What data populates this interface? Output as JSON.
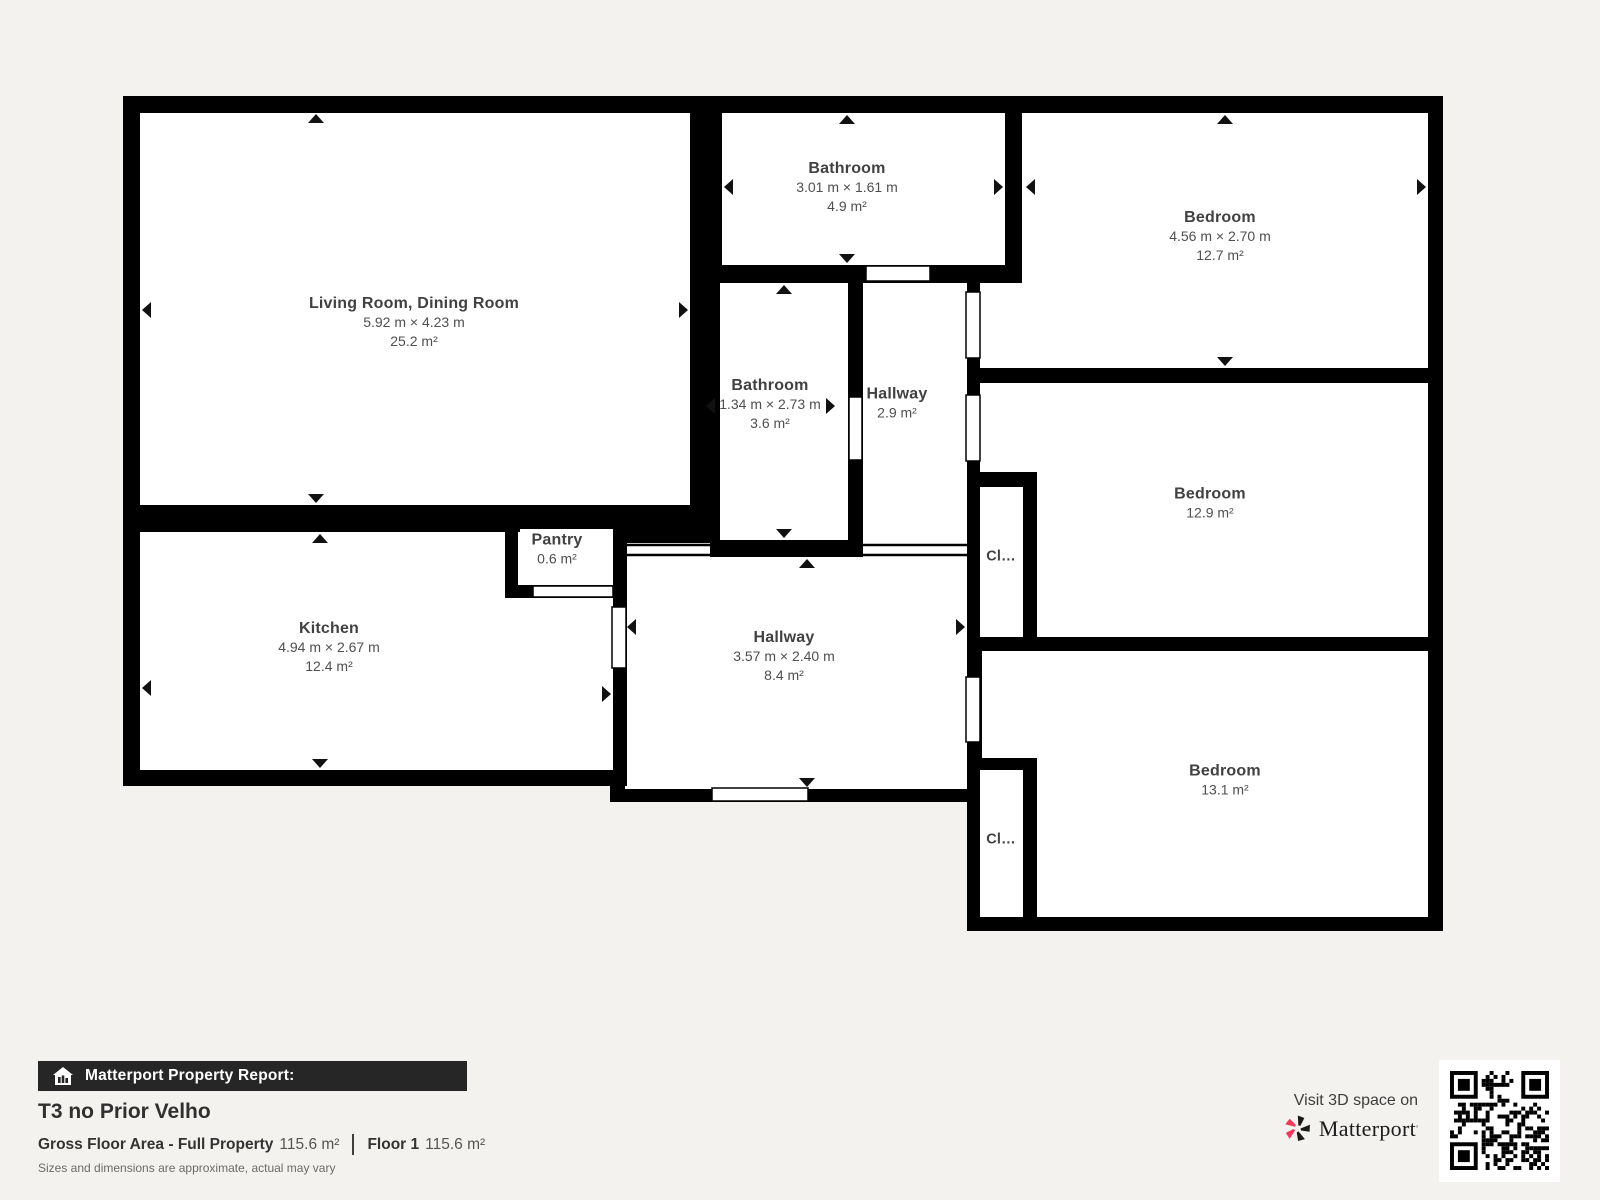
{
  "plan": {
    "rooms": [
      {
        "id": "living-dining",
        "name": "Living Room, Dining Room",
        "dims": "5.92 m × 4.23 m",
        "area": "25.2 m²"
      },
      {
        "id": "bathroom-top",
        "name": "Bathroom",
        "dims": "3.01 m × 1.61 m",
        "area": "4.9 m²"
      },
      {
        "id": "bedroom-top",
        "name": "Bedroom",
        "dims": "4.56 m × 2.70 m",
        "area": "12.7 m²"
      },
      {
        "id": "bathroom-mid",
        "name": "Bathroom",
        "dims": "1.34 m × 2.73 m",
        "area": "3.6 m²"
      },
      {
        "id": "hallway-small",
        "name": "Hallway",
        "area": "2.9 m²"
      },
      {
        "id": "bedroom-mid",
        "name": "Bedroom",
        "area": "12.9 m²"
      },
      {
        "id": "kitchen",
        "name": "Kitchen",
        "dims": "4.94 m × 2.67 m",
        "area": "12.4 m²"
      },
      {
        "id": "pantry",
        "name": "Pantry",
        "area": "0.6 m²"
      },
      {
        "id": "hallway-main",
        "name": "Hallway",
        "dims": "3.57 m × 2.40 m",
        "area": "8.4 m²"
      },
      {
        "id": "bedroom-bottom",
        "name": "Bedroom",
        "area": "13.1 m²"
      },
      {
        "id": "closet-1",
        "name": "Cl…"
      },
      {
        "id": "closet-2",
        "name": "Cl…"
      }
    ]
  },
  "footer": {
    "report_label": "Matterport Property Report:",
    "title": "T3 no Prior Velho",
    "gross_label": "Gross Floor Area - Full Property",
    "gross_value": "115.6 m²",
    "floor_label": "Floor 1",
    "floor_value": "115.6 m²",
    "disclaimer": "Sizes and dimensions are approximate, actual may vary"
  },
  "promo": {
    "visit_text": "Visit 3D space on",
    "brand": "Matterport",
    "brand_mark": "’"
  },
  "colors": {
    "background": "#f3f2ef",
    "wall": "#000000",
    "room_fill": "#ffffff",
    "footer_bar": "#262626",
    "accent_pink": "#f4365f"
  }
}
